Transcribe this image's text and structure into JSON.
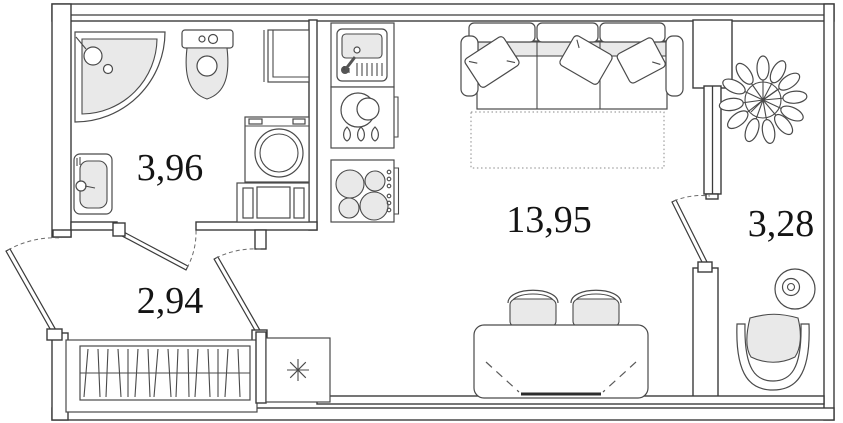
{
  "plan": {
    "rooms": [
      {
        "id": "bathroom",
        "area": "3,96"
      },
      {
        "id": "hallway",
        "area": "2,94"
      },
      {
        "id": "living-room",
        "area": "13,95"
      },
      {
        "id": "balcony",
        "area": "3,28"
      }
    ],
    "symbols": [
      "corner-shower",
      "toilet",
      "wall-cabinet",
      "washing-machine",
      "laundry-cabinet",
      "bathroom-sink",
      "kitchen-sink",
      "kitchen-pots",
      "stove",
      "fridge-asterisk",
      "wardrobe-hangers",
      "entrance-door",
      "bathroom-door",
      "room-door",
      "balcony-door",
      "window",
      "sofa-bed",
      "pillows",
      "bed-extension-dotted",
      "dining-table",
      "chairs",
      "plant",
      "round-table",
      "armchair"
    ],
    "colors": {
      "line": "#3b3b3b",
      "fixture_fill": "#e9e9e9",
      "background": "#ffffff",
      "label": "#141414"
    }
  }
}
